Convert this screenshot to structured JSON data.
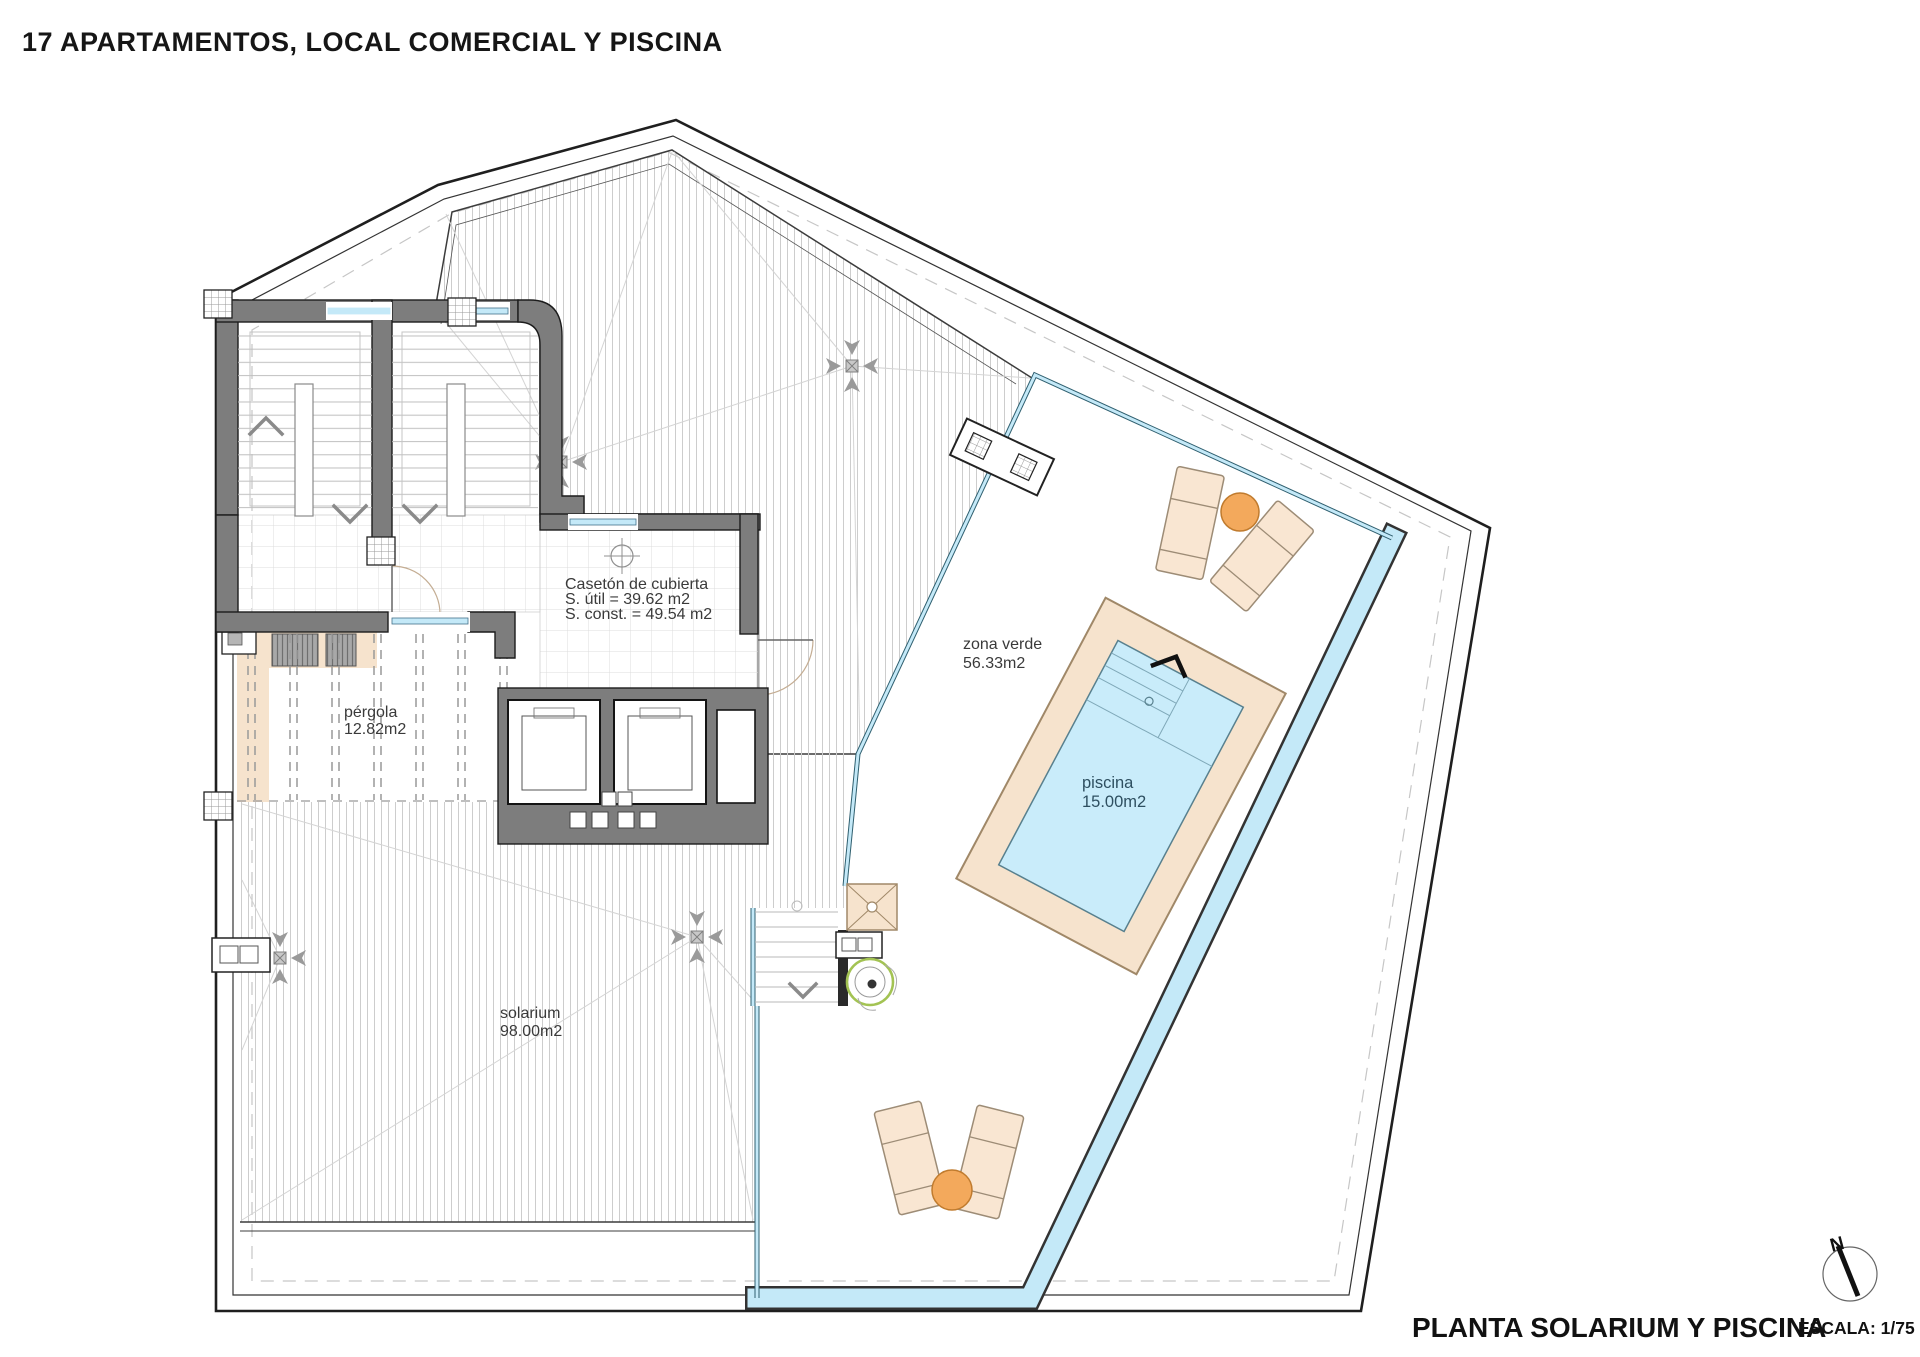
{
  "title": "17 APARTAMENTOS, LOCAL COMERCIAL Y PISCINA",
  "footer": {
    "plan_title": "PLANTA SOLARIUM Y PISCINA",
    "scale_label": "ESCALA: 1/75"
  },
  "compass": {
    "north_label": "N"
  },
  "rooms": {
    "caseton": {
      "name": "Casetón de cubierta",
      "util": "S. útil = 39.62 m2",
      "const": "S. const. = 49.54 m2"
    },
    "zona_verde": {
      "name": "zona verde",
      "area": "56.33m2"
    },
    "pergola": {
      "name": "pérgola",
      "area": "12.82m2"
    },
    "piscina": {
      "name": "piscina",
      "area": "15.00m2"
    },
    "solarium": {
      "name": "solarium",
      "area": "98.00m2"
    }
  },
  "colors": {
    "wall_gray": "#7d7d7d",
    "deck_beige": "#f6e3cd",
    "pool_water": "#c9ecfa",
    "glass_blue": "#c4e9f8",
    "accent_orange": "#f3a95c",
    "lounger_beige": "#f9e6d2",
    "plant_green": "#a3c353",
    "line_dark": "#1f1f1f"
  }
}
